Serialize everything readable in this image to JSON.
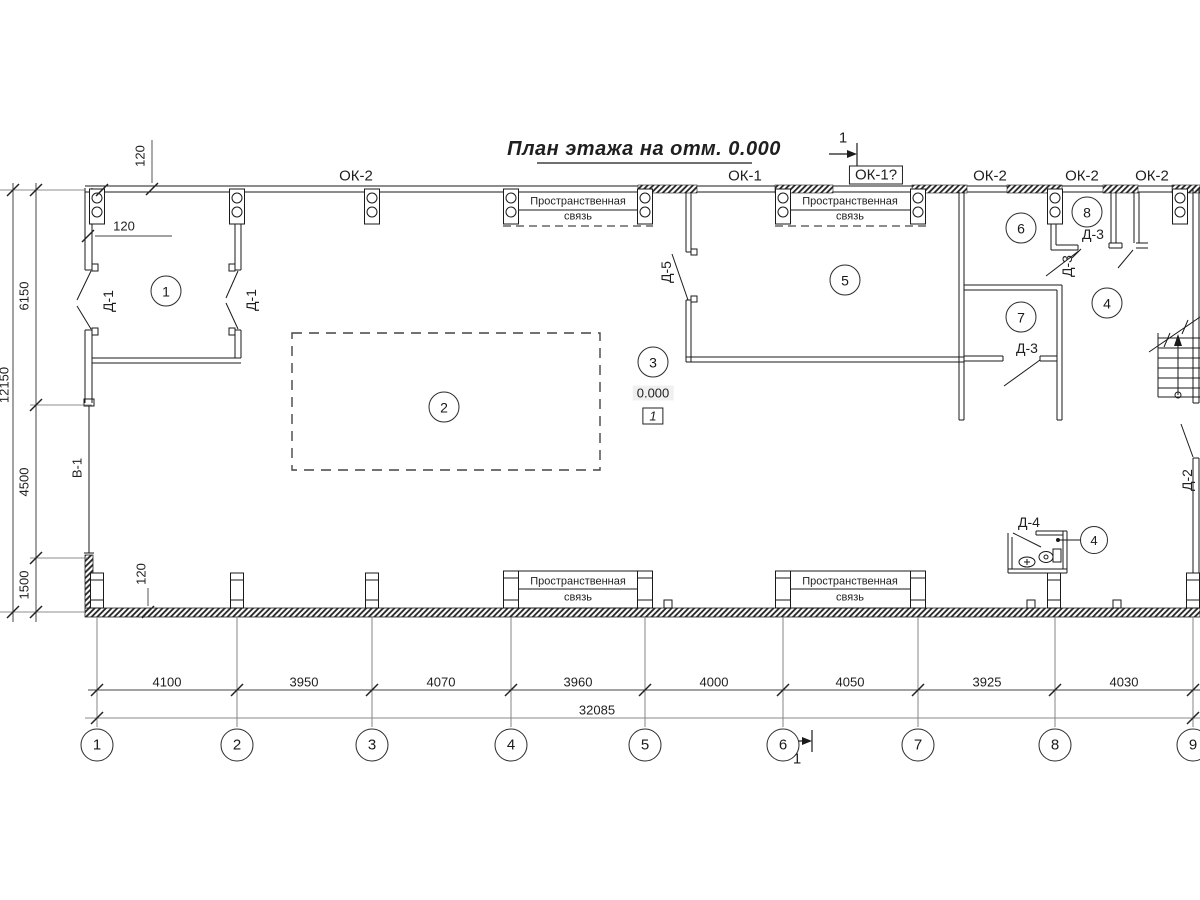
{
  "title": "План этажа на отм. 0.000",
  "section": {
    "num": "1"
  },
  "windows": {
    "ok2": "ОК-2",
    "ok1": "ОК-1",
    "ok1q": "ОК-1?"
  },
  "tie": {
    "l1": "Пространственная",
    "l2": "связь"
  },
  "rooms": {
    "r1": "1",
    "r2": "2",
    "r3": "3",
    "r4": "4",
    "r5": "5",
    "r6": "6",
    "r7": "7",
    "r8": "8"
  },
  "doors": {
    "d1": "Д-1",
    "d2": "Д-2",
    "d3": "Д-3",
    "d4": "Д-4",
    "d5": "Д-5",
    "v1": "В-1"
  },
  "elevation": {
    "value": "0.000",
    "node": "1"
  },
  "dims": {
    "b": [
      "4100",
      "3950",
      "4070",
      "3960",
      "4000",
      "4050",
      "3925",
      "4030"
    ],
    "total": "32085",
    "left": [
      "6150",
      "4500",
      "1500"
    ],
    "left_total": "12150",
    "t120": "120"
  },
  "grid": [
    "1",
    "2",
    "3",
    "4",
    "5",
    "6",
    "7",
    "8",
    "9"
  ]
}
